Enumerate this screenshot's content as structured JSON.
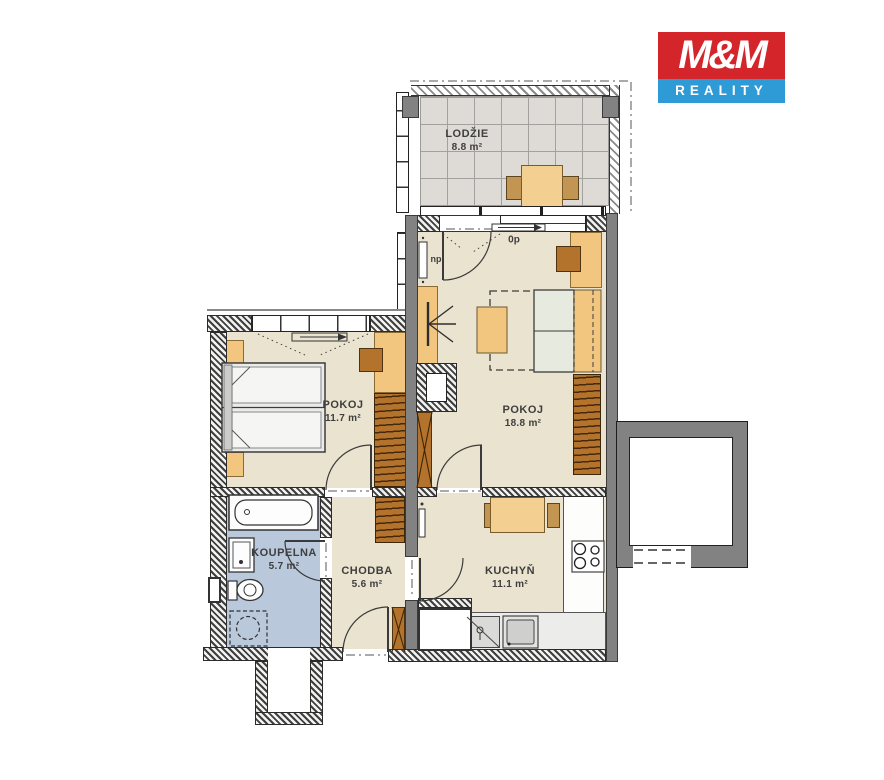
{
  "logo": {
    "mm": "M&M",
    "reality": "REALITY",
    "red": "#d4252b",
    "blue": "#2e9ad6"
  },
  "plan": {
    "rooms": [
      {
        "id": "lodzie",
        "name": "LODŽIE",
        "area": "8.8 m²"
      },
      {
        "id": "pokoj-velky",
        "name": "POKOJ",
        "area": "18.8 m²"
      },
      {
        "id": "pokoj-maly",
        "name": "POKOJ",
        "area": "11.7 m²"
      },
      {
        "id": "koupelna",
        "name": "KOUPELNA",
        "area": "5.7 m²"
      },
      {
        "id": "chodba",
        "name": "CHODBA",
        "area": "5.6 m²"
      },
      {
        "id": "kuchyn",
        "name": "KUCHYŇ",
        "area": "11.1 m²"
      }
    ],
    "annotations": {
      "door_threshold": "0p",
      "niche": "np"
    },
    "colors": {
      "floor": "#eae3d0",
      "bathroom_floor": "#b9c8da",
      "loggia_tile": "#dedbd6",
      "furniture_orange": "#f2c67f",
      "furniture_brown": "#b4732d",
      "wall_gray": "#828282"
    }
  }
}
